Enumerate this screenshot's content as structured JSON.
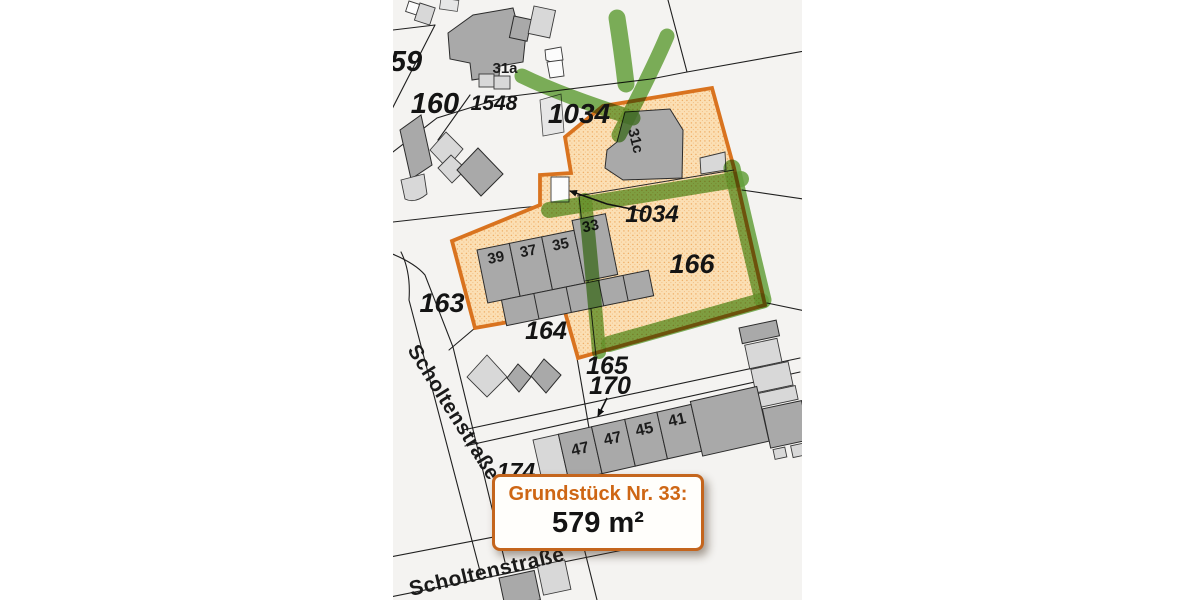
{
  "colors": {
    "highlight_border": "#d9731f",
    "highlight_fill": "#fbdfb4",
    "marker_green": "#6aa83f",
    "info_title_orange": "#ce6614",
    "building_gray": "#a9a9a9",
    "building_light": "#d8d8d8",
    "paper": "#f4f3f1"
  },
  "info_box": {
    "title": "Grundstück Nr. 33:",
    "area": "579 m²"
  },
  "map": {
    "parcels": {
      "p59": "59",
      "p160": "160",
      "p1548": "1548",
      "p1034_top": "1034",
      "p1034_mid": "1034",
      "p166": "166",
      "p163": "163",
      "p164": "164",
      "p165": "165",
      "p170": "170",
      "p174": "174"
    },
    "houses": {
      "h31a": "31a",
      "h31c": "31c",
      "h39": "39",
      "h37": "37",
      "h35": "35",
      "h33": "33",
      "h47a": "47",
      "h47b": "47",
      "h45": "45",
      "h41": "41"
    },
    "streets": {
      "main": "Scholtenstraße",
      "bottom": "Scholtenstraße"
    }
  }
}
